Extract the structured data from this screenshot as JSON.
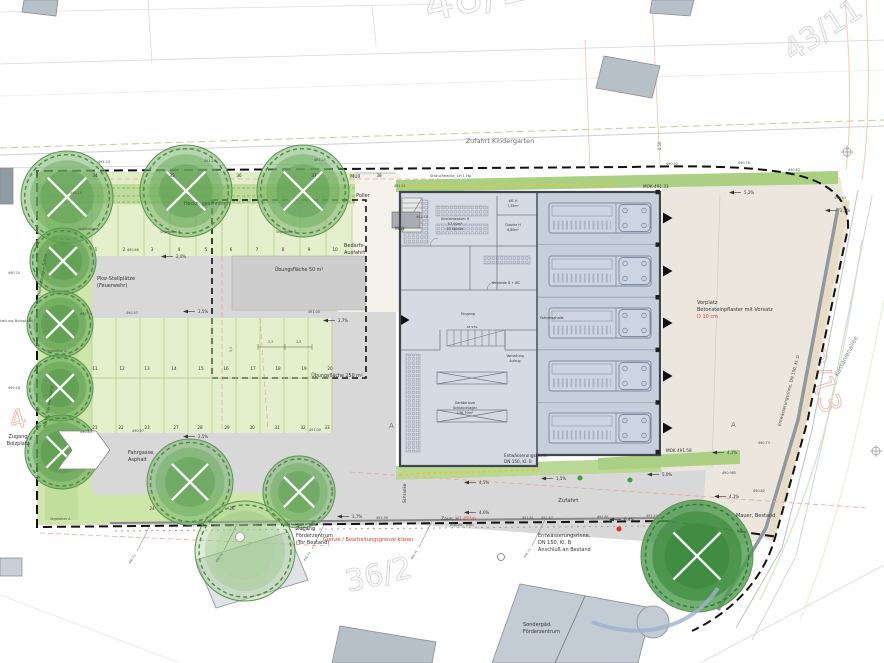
{
  "colors": {
    "lawn": "#e4f0cb",
    "hedge": "#b9d893",
    "leftstrip": "#cfe6ab",
    "mokstrip": "#abd084",
    "asphalt": "#d8d8d8",
    "pale": "#f4f2ea",
    "beige": "#ebe7de",
    "pad": "#cdcdcd",
    "wing": "#d4dbe5",
    "hall": "#c6cfdc",
    "truck": "#ccd5e1",
    "wall": "#41464d",
    "red": "#e03a2f",
    "pink_guide": "#eba6a0",
    "yellow": "#ddc93a",
    "grey_wall": "#9099a0"
  },
  "parcel_numbers": [
    {
      "n": "parcel-48-18",
      "t": "48/18",
      "x": 428,
      "y": 22,
      "s": 46,
      "r": -13,
      "c": "#d4d4d4"
    },
    {
      "n": "parcel-43-11",
      "t": "43/11",
      "x": 792,
      "y": 62,
      "s": 30,
      "r": -33,
      "c": "#d4d4d4"
    },
    {
      "n": "parcel-36-2",
      "t": "36/2",
      "x": 348,
      "y": 592,
      "s": 30,
      "r": -13,
      "c": "#d4d4d4"
    },
    {
      "n": "parcel-43-13",
      "t": "43/13",
      "x": 797,
      "y": 333,
      "s": 30,
      "r": 73,
      "c": "#f0b5aa"
    },
    {
      "n": "parcel-4",
      "t": "4",
      "x": 12,
      "y": 430,
      "s": 26,
      "r": -15,
      "c": "#f0b5aa"
    }
  ],
  "labels": [
    {
      "n": "zufahrt-kindergarten",
      "t": "Zufahrt Kindergarten",
      "x": 500,
      "y": 143,
      "s": 6.5,
      "c": "#6f6f6f",
      "a": "middle"
    },
    {
      "n": "dim-4-50",
      "t": "4,50",
      "x": 661,
      "y": 146,
      "s": 4,
      "c": "#555",
      "r": -90,
      "a": "middle"
    },
    {
      "n": "muell-top",
      "t": "Müll",
      "x": 350,
      "y": 178,
      "s": 5
    },
    {
      "n": "poller",
      "t": "Poller",
      "x": 356,
      "y": 197,
      "s": 5
    },
    {
      "n": "bedarfsausfahrt-1",
      "t": "Bedarfs-",
      "x": 344,
      "y": 247,
      "s": 5
    },
    {
      "n": "bedarfsausfahrt-2",
      "t": "Ausfahrt",
      "x": 344,
      "y": 254,
      "s": 5
    },
    {
      "n": "muell-building",
      "t": "Müll",
      "x": 395,
      "y": 230,
      "s": 4.5
    },
    {
      "n": "hecke-geschnitten",
      "t": "Hecke, geschnitten",
      "x": 207,
      "y": 205,
      "s": 4.8,
      "c": "#2f5c2f",
      "a": "middle"
    },
    {
      "n": "pflanzstreifen",
      "t": "Strauchhecke, LH 1 Hp",
      "x": 430,
      "y": 177,
      "s": 3.6,
      "c": "#444"
    },
    {
      "n": "pkw-stellplaetze-1",
      "t": "Pkw-Stellplätze",
      "x": 97,
      "y": 280,
      "s": 5
    },
    {
      "n": "pkw-stellplaetze-2",
      "t": "(Feuerwehr)",
      "x": 97,
      "y": 287,
      "s": 5
    },
    {
      "n": "uebungsflaeche-50",
      "t": "Übungsfläche 50 m²",
      "x": 299,
      "y": 271,
      "s": 4.8,
      "a": "middle"
    },
    {
      "n": "uebungsflaeche-250",
      "t": "Übungsfläche 250 m²",
      "x": 337,
      "y": 377,
      "s": 4.8,
      "a": "middle"
    },
    {
      "n": "fahrgasse-1",
      "t": "Fahrgasse,",
      "x": 128,
      "y": 454,
      "s": 5
    },
    {
      "n": "fahrgasse-2",
      "t": "Asphalt",
      "x": 128,
      "y": 461,
      "s": 5
    },
    {
      "n": "zugang-bolzplatz-1",
      "t": "Zugang",
      "x": 18,
      "y": 438,
      "s": 5,
      "a": "middle"
    },
    {
      "n": "zugang-bolzplatz-2",
      "t": "Bolzplatz",
      "x": 18,
      "y": 445,
      "s": 5,
      "a": "middle"
    },
    {
      "n": "bolzplatz-edge",
      "t": "nstellung Bolzplatz)",
      "x": -4,
      "y": 322,
      "s": 3.8,
      "c": "#555"
    },
    {
      "n": "hecke-frei-wachsend",
      "t": "Hecke, frei wachsend",
      "x": 46,
      "y": 428,
      "s": 4,
      "c": "#2f5c2f",
      "r": -80
    },
    {
      "n": "bepflanzung",
      "t": "Bepflanzung = 5,0 m",
      "x": 40,
      "y": 296,
      "s": 4,
      "c": "#2f5c2f",
      "r": -80
    },
    {
      "n": "vegetation-b-1",
      "t": "Vegetation B",
      "x": 78,
      "y": 230,
      "s": 3.2,
      "c": "#555"
    },
    {
      "n": "vegetation-b-2",
      "t": "Vegetation B",
      "x": 160,
      "y": 233,
      "s": 3.2,
      "c": "#555"
    },
    {
      "n": "vegetation-b-3",
      "t": "Vegetation B",
      "x": 276,
      "y": 233,
      "s": 3.2,
      "c": "#555"
    },
    {
      "n": "vegetation-a-1",
      "t": "Vegetation A",
      "x": 46,
      "y": 352,
      "s": 3.2,
      "c": "#555"
    },
    {
      "n": "vegetation-a-2",
      "t": "Vegetation A",
      "x": 50,
      "y": 520,
      "s": 3.2,
      "c": "#555"
    },
    {
      "n": "zugang-foerderzentrum-1",
      "t": "Zugang",
      "x": 296,
      "y": 530,
      "s": 5
    },
    {
      "n": "zugang-foerderzentrum-2",
      "t": "Förderzentrum",
      "x": 296,
      "y": 537,
      "s": 5
    },
    {
      "n": "zugang-foerderzentrum-3",
      "t": "(Tor Bestand)",
      "x": 296,
      "y": 544,
      "s": 5
    },
    {
      "n": "grenze-klaeren",
      "t": "Grenze / Bearbeitungsgrenze klären",
      "x": 368,
      "y": 541,
      "s": 5,
      "c": "#e03a2f",
      "a": "middle"
    },
    {
      "n": "mauer-neu",
      "t": "Mauer, neu",
      "x": 450,
      "y": 526,
      "s": 4.2,
      "c": "#555"
    },
    {
      "n": "zaun-h",
      "t": "Zaun, H",
      "x": 441,
      "y": 520,
      "s": 4.5
    },
    {
      "n": "zaun-mass",
      "t": "1,47?m",
      "x": 459,
      "y": 520,
      "s": 4.5,
      "c": "#e03a2f"
    },
    {
      "n": "schranke",
      "t": "Schranke",
      "x": 406,
      "y": 503,
      "s": 4.2,
      "r": -90
    },
    {
      "n": "zufahrt",
      "t": "Zufahrt",
      "x": 558,
      "y": 502,
      "s": 5.5
    },
    {
      "n": "entw-rinne-geb-1",
      "t": "Entwässerungsrinne,",
      "x": 504,
      "y": 457,
      "s": 4.2
    },
    {
      "n": "entw-rinne-geb-2",
      "t": "DN 150, Kl. B",
      "x": 504,
      "y": 463,
      "s": 4.2
    },
    {
      "n": "entw-rinne-bestand-1",
      "t": "Entwässerungsrinne,",
      "x": 538,
      "y": 537,
      "s": 5
    },
    {
      "n": "entw-rinne-bestand-2",
      "t": "DN 150, Kl. B",
      "x": 538,
      "y": 544,
      "s": 5
    },
    {
      "n": "entw-rinne-bestand-3",
      "t": "Anschluß an Bestand",
      "x": 538,
      "y": 551,
      "s": 5
    },
    {
      "n": "mok-491-33",
      "t": "MOK 491.33",
      "x": 643,
      "y": 188,
      "s": 4.2
    },
    {
      "n": "mok-491-58",
      "t": "MOK 491.58",
      "x": 666,
      "y": 452,
      "s": 4.2
    },
    {
      "n": "vorplatz-1",
      "t": "Vorplatz",
      "x": 697,
      "y": 304,
      "s": 5
    },
    {
      "n": "vorplatz-2",
      "t": "Betonsteinpflaster mit Vorsatz",
      "x": 697,
      "y": 311,
      "s": 5
    },
    {
      "n": "vorplatz-3",
      "t": "D 10 cm",
      "x": 697,
      "y": 318,
      "s": 5,
      "c": "#e03a2f"
    },
    {
      "n": "kastanienallee",
      "t": "Kastanienallee",
      "x": 848,
      "y": 357,
      "s": 6,
      "c": "#8a8a8a",
      "r": -63,
      "a": "middle"
    },
    {
      "n": "entw-rinne-strasse",
      "t": "Entwässerungsrinne, DN 150, Kl. D",
      "x": 790,
      "y": 391,
      "s": 4.2,
      "c": "#444",
      "r": -75,
      "a": "middle"
    },
    {
      "n": "mauer-bestand",
      "t": "Mauer, Bestand",
      "x": 736,
      "y": 517,
      "s": 5
    },
    {
      "n": "sonderpaed-1",
      "t": "Sonderpäd.",
      "x": 523,
      "y": 626,
      "s": 5
    },
    {
      "n": "sonderpaed-2",
      "t": "Förderzentrum",
      "x": 523,
      "y": 633,
      "s": 5
    },
    {
      "n": "room-umkleideraum-1",
      "t": "Umkleideraum H",
      "x": 455,
      "y": 220,
      "s": 3.4,
      "a": "middle"
    },
    {
      "n": "room-umkleideraum-2",
      "t": "57,00m²",
      "x": 455,
      "y": 225,
      "s": 3.4,
      "a": "middle"
    },
    {
      "n": "room-umkleideraum-3",
      "t": "40 Spinde",
      "x": 455,
      "y": 230,
      "s": 3.4,
      "a": "middle"
    },
    {
      "n": "room-wc-1",
      "t": "WC H",
      "x": 513,
      "y": 202,
      "s": 3.2,
      "a": "middle"
    },
    {
      "n": "room-wc-2",
      "t": "7,35m²",
      "x": 513,
      "y": 207,
      "s": 3.2,
      "a": "middle"
    },
    {
      "n": "room-dusche-1",
      "t": "Dusche H",
      "x": 513,
      "y": 226,
      "s": 3.2,
      "a": "middle"
    },
    {
      "n": "room-dusche-2",
      "t": "8,80m²",
      "x": 513,
      "y": 231,
      "s": 3.2,
      "a": "middle"
    },
    {
      "n": "room-umkleide-d",
      "t": "Umkleide D + WC",
      "x": 506,
      "y": 284,
      "s": 3.2,
      "a": "middle"
    },
    {
      "n": "room-eingang",
      "t": "Eingang",
      "x": 468,
      "y": 315,
      "s": 3.4,
      "a": "middle"
    },
    {
      "n": "room-treppe",
      "t": "18 STG",
      "x": 472,
      "y": 328,
      "s": 3,
      "a": "middle"
    },
    {
      "n": "room-vorhaltung-1",
      "t": "Vorhaltung",
      "x": 515,
      "y": 357,
      "s": 3.2,
      "a": "middle"
    },
    {
      "n": "room-vorhaltung-2",
      "t": "Aufzug",
      "x": 515,
      "y": 362,
      "s": 3.2,
      "a": "middle"
    },
    {
      "n": "room-geraeteraum-1",
      "t": "Geräteraum",
      "x": 465,
      "y": 404,
      "s": 3.4,
      "a": "middle"
    },
    {
      "n": "room-geraeteraum-2",
      "t": "Schlauchlager",
      "x": 465,
      "y": 409,
      "s": 3.4,
      "a": "middle"
    },
    {
      "n": "room-geraeteraum-3",
      "t": "136,70m²",
      "x": 465,
      "y": 414,
      "s": 3.4,
      "a": "middle"
    },
    {
      "n": "room-fahrzeughalle",
      "t": "Fahrzeughalle",
      "x": 540,
      "y": 319,
      "s": 3.4
    },
    {
      "n": "section-a-left",
      "t": "A",
      "x": 389,
      "y": 428,
      "s": 7,
      "c": "#777"
    },
    {
      "n": "section-a-right",
      "t": "A",
      "x": 731,
      "y": 427,
      "s": 7,
      "c": "#777"
    },
    {
      "n": "dim-2-5-a",
      "t": "2,5",
      "x": 268,
      "y": 343,
      "s": 3.4,
      "c": "#555"
    },
    {
      "n": "dim-2-5-b",
      "t": "2,5",
      "x": 296,
      "y": 343,
      "s": 3.4,
      "c": "#555"
    },
    {
      "n": "dim-5-0",
      "t": "5,0",
      "x": 232,
      "y": 352,
      "s": 3.4,
      "c": "#555",
      "r": -90
    }
  ],
  "elevations": [
    [
      "491.21",
      394,
      187
    ],
    [
      "491.15",
      416,
      218
    ],
    [
      "490.68",
      127,
      251
    ],
    [
      "490.15",
      70,
      194
    ],
    [
      "490.44",
      80,
      315
    ],
    [
      "490.57",
      126,
      314
    ],
    [
      "491.00",
      308,
      313
    ],
    [
      "490.44",
      80,
      433
    ],
    [
      "490.57",
      132,
      432
    ],
    [
      "491.00",
      309,
      431
    ],
    [
      "490.20",
      8,
      274
    ],
    [
      "490.18",
      8,
      389
    ],
    [
      "491.39",
      376,
      519
    ],
    [
      "491.61",
      522,
      519
    ],
    [
      "491.67",
      541,
      519
    ],
    [
      "491.81",
      597,
      518
    ],
    [
      "491.47",
      646,
      517
    ],
    [
      "490.82",
      753,
      492
    ],
    [
      "490.73",
      758,
      444
    ],
    [
      "490.985",
      722,
      474
    ],
    [
      "490.92",
      666,
      165
    ],
    [
      "490.76",
      738,
      164
    ],
    [
      "490.63",
      788,
      171
    ],
    [
      "490.54",
      834,
      199
    ],
    [
      "491.23",
      98,
      163
    ],
    [
      "491.20",
      204,
      162
    ],
    [
      "491.25",
      314,
      161
    ]
  ],
  "slopes": [
    [
      "2,0%",
      176,
      258
    ],
    [
      "2,5%",
      198,
      313
    ],
    [
      "2,7%",
      338,
      322
    ],
    [
      "2,5%",
      198,
      438
    ],
    [
      "4,5%",
      479,
      484
    ],
    [
      "4,6%",
      479,
      514
    ],
    [
      "1,5%",
      556,
      480
    ],
    [
      "6,4%",
      624,
      521
    ],
    [
      "5,0%",
      662,
      476
    ],
    [
      "4,1%",
      727,
      454
    ],
    [
      "4,1%",
      729,
      498
    ],
    [
      "5,2%",
      744,
      194
    ],
    [
      "2,5%",
      840,
      212
    ],
    [
      "1,7%",
      352,
      518
    ]
  ],
  "stall_rows": [
    {
      "name": "stall-row-top",
      "y": 177,
      "items": [
        [
          "34",
          95
        ],
        [
          "35",
          172
        ],
        [
          "36",
          239
        ],
        [
          "37",
          314
        ],
        [
          "38",
          379
        ]
      ]
    },
    {
      "name": "stall-row-1",
      "y": 251,
      "items": [
        [
          "1",
          96
        ],
        [
          "2",
          124
        ],
        [
          "3",
          152
        ],
        [
          "4",
          179
        ],
        [
          "5",
          206
        ],
        [
          "6",
          231
        ],
        [
          "7",
          257
        ],
        [
          "8",
          283
        ],
        [
          "9",
          309
        ],
        [
          "10",
          335
        ]
      ]
    },
    {
      "name": "stall-row-2",
      "y": 370,
      "items": [
        [
          "11",
          95
        ],
        [
          "12",
          122
        ],
        [
          "13",
          147
        ],
        [
          "14",
          174
        ],
        [
          "15",
          201
        ],
        [
          "16",
          226
        ],
        [
          "17",
          253
        ],
        [
          "18",
          278
        ],
        [
          "19",
          304
        ],
        [
          "20",
          330
        ]
      ]
    },
    {
      "name": "stall-row-3",
      "y": 429,
      "items": [
        [
          "21",
          95
        ],
        [
          "22",
          121
        ],
        [
          "23",
          147
        ],
        [
          "27",
          176
        ],
        [
          "28",
          200
        ],
        [
          "29",
          227
        ],
        [
          "30",
          252
        ],
        [
          "31",
          277
        ],
        [
          "32",
          303
        ],
        [
          "33",
          327
        ]
      ]
    },
    {
      "name": "stall-row-bottom",
      "y": 510,
      "items": [
        [
          "24",
          152
        ],
        [
          "26",
          232
        ]
      ]
    }
  ],
  "leaders": [
    {
      "x": 150,
      "label": "490.73"
    },
    {
      "x": 237,
      "label": "490.74"
    },
    {
      "x": 325,
      "label": "490.72"
    },
    {
      "x": 432,
      "label": "490.75"
    },
    {
      "x": 545,
      "label": "490.73"
    }
  ],
  "trees": [
    {
      "cx": 67,
      "cy": 197,
      "r": 46,
      "k": "B"
    },
    {
      "cx": 186,
      "cy": 191,
      "r": 46,
      "k": "B"
    },
    {
      "cx": 303,
      "cy": 191,
      "r": 46,
      "k": "B"
    },
    {
      "cx": 63,
      "cy": 261,
      "r": 33,
      "k": "A"
    },
    {
      "cx": 60,
      "cy": 324,
      "r": 33,
      "k": "A"
    },
    {
      "cx": 60,
      "cy": 388,
      "r": 33,
      "k": "A"
    },
    {
      "cx": 62,
      "cy": 452,
      "r": 37,
      "k": "A"
    },
    {
      "cx": 190,
      "cy": 482,
      "r": 43,
      "k": "B"
    },
    {
      "cx": 299,
      "cy": 492,
      "r": 36,
      "k": "B"
    },
    {
      "cx": 245,
      "cy": 551,
      "r": 50,
      "k": "light"
    },
    {
      "cx": 697,
      "cy": 556,
      "r": 56,
      "k": "dark"
    }
  ],
  "building": {
    "truck_x": 549,
    "bay_centers": [
      218,
      271,
      323,
      376,
      428
    ],
    "bay_divider_ys": [
      244.6,
      297.2,
      349.8,
      402.4
    ],
    "wall_square_ys": [
      192,
      244.6,
      297.2,
      349.8,
      402.4,
      452
    ],
    "door_triangle_ys": [
      218,
      271,
      323,
      376,
      428
    ]
  },
  "stall_dividers": {
    "row1": {
      "x0": 92,
      "x1": 352,
      "step": 26,
      "y0": 206,
      "y1": 256
    },
    "row23": {
      "x0": 92,
      "x1": 332,
      "step": 24,
      "y0": 318,
      "y1": 433,
      "mid": 378
    }
  }
}
